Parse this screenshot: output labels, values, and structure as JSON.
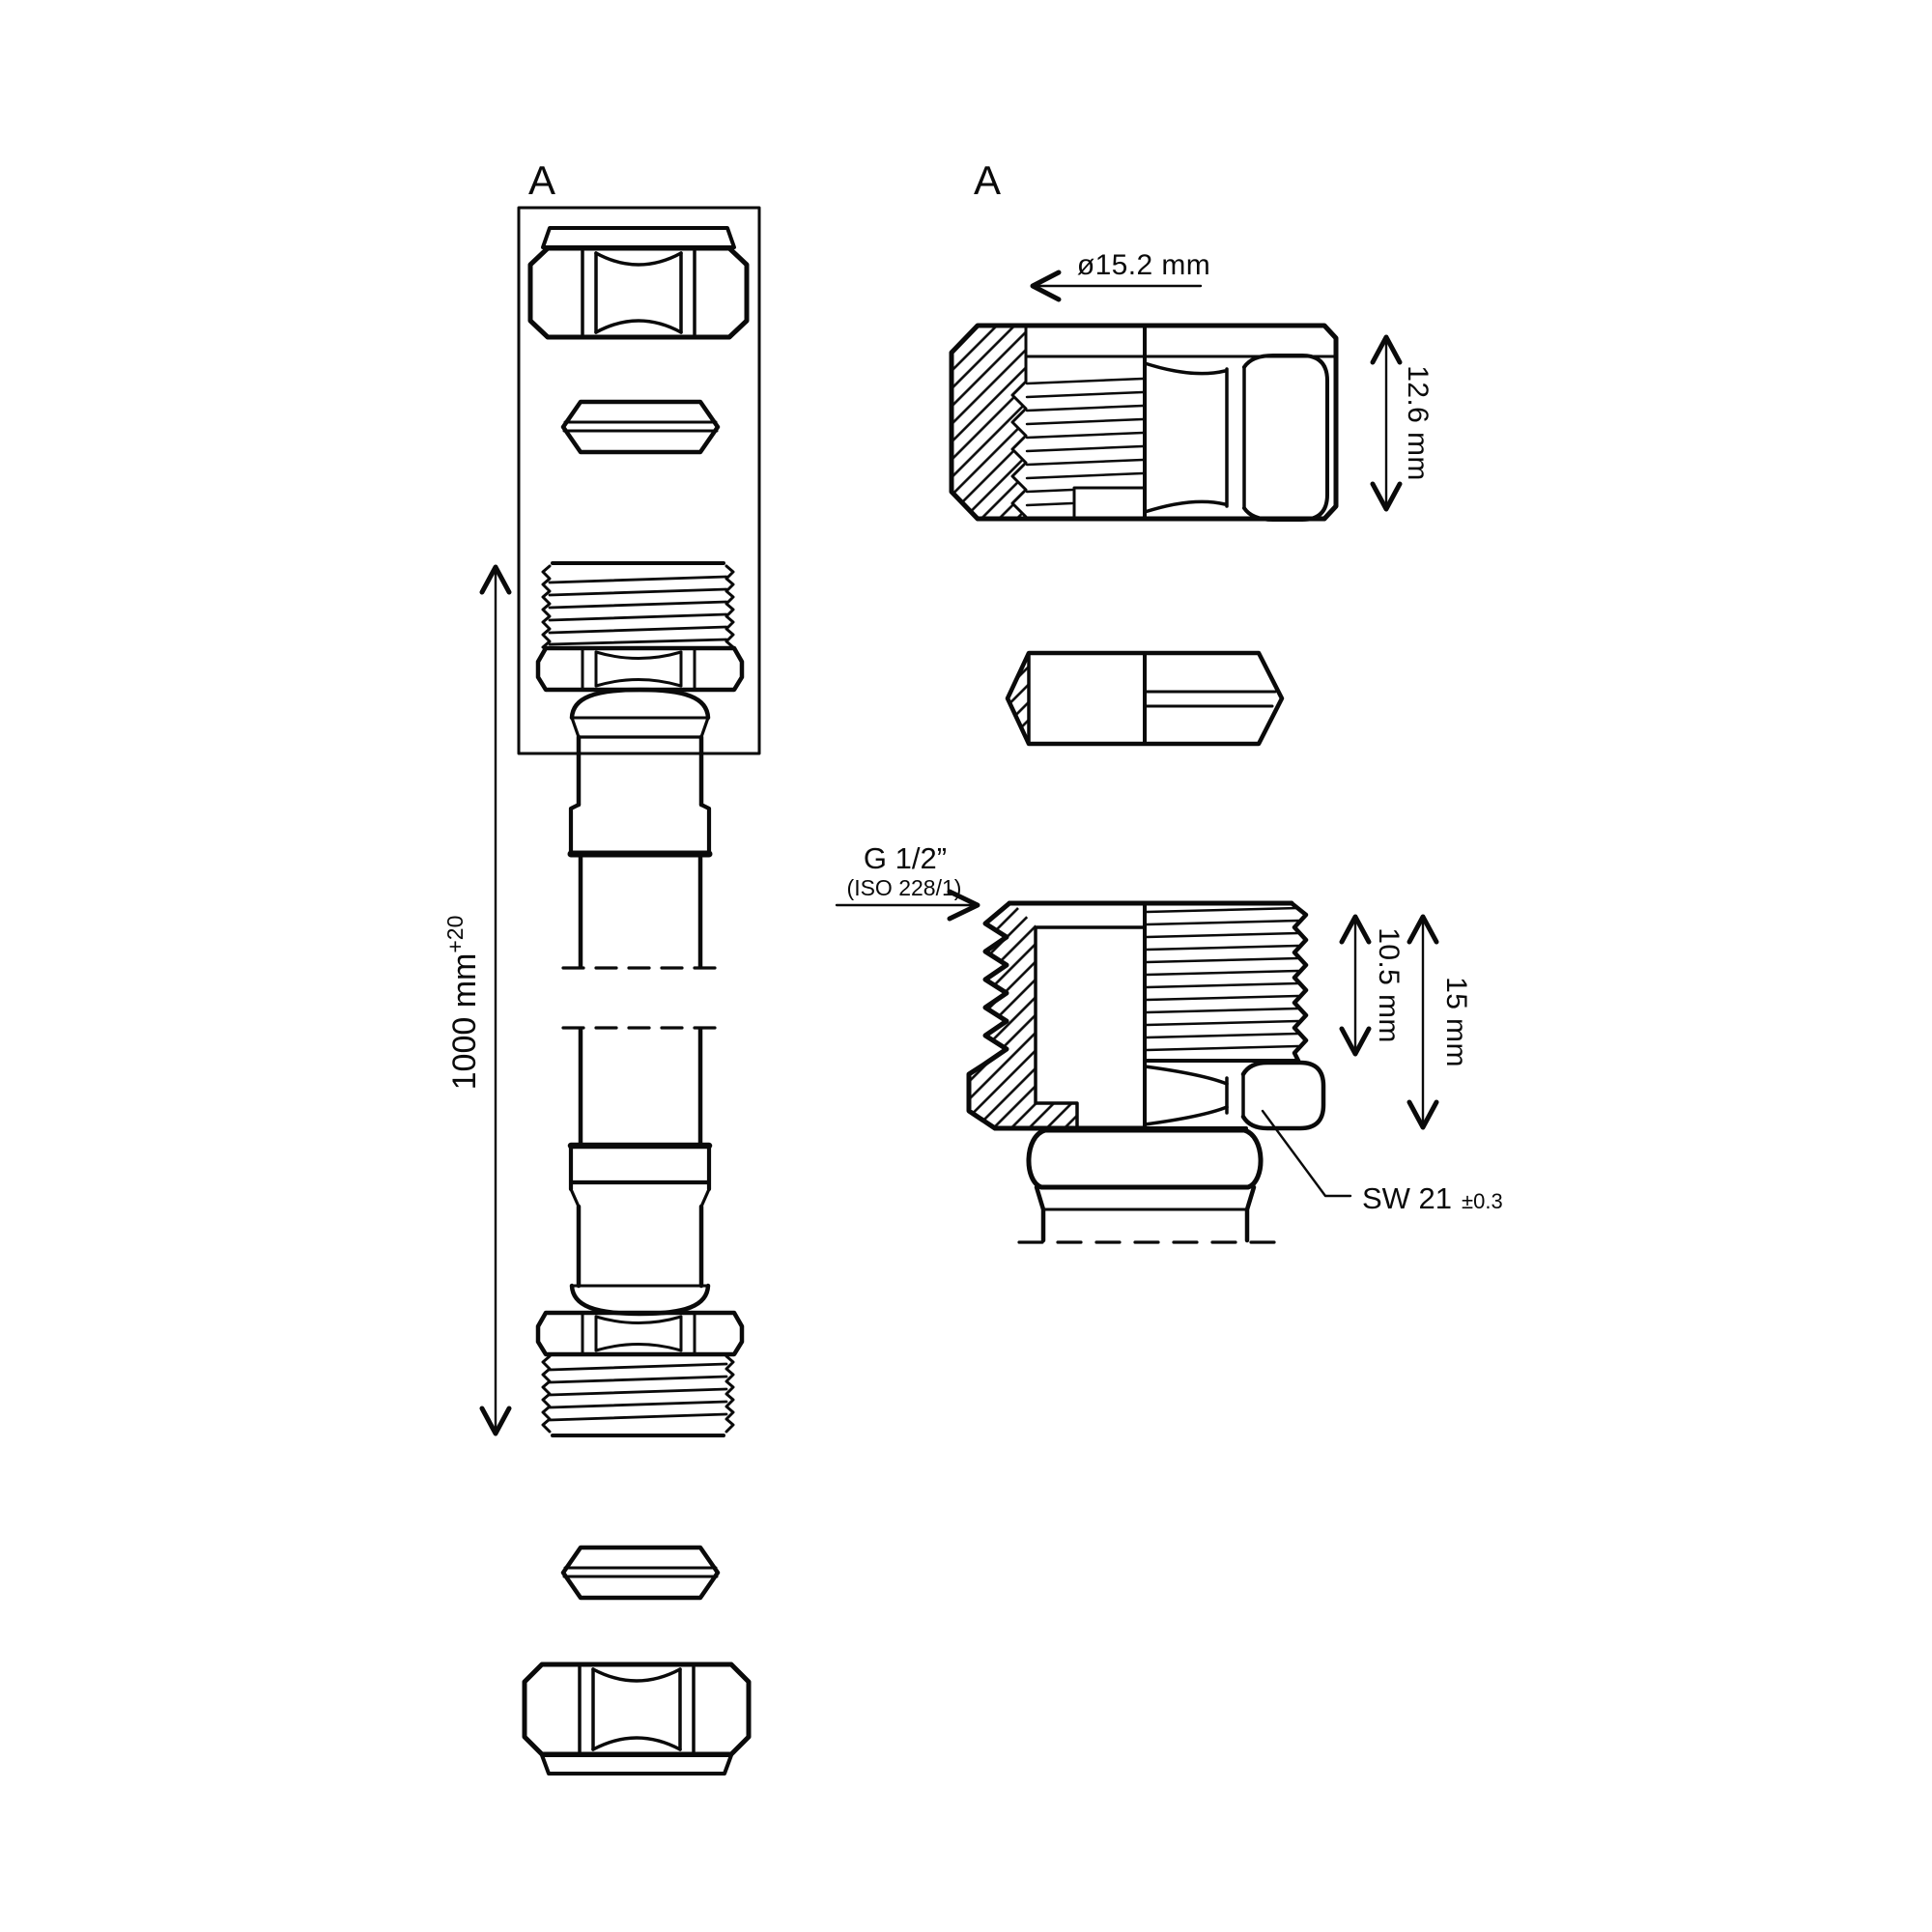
{
  "colors": {
    "ink": "#0a0a0a",
    "paper": "#ffffff"
  },
  "left_view": {
    "detail_label": "A",
    "length_dimension": {
      "value": "1000 mm",
      "tolerance": "+20"
    }
  },
  "detail_view": {
    "label": "A",
    "dimensions": {
      "outer_diameter": "ø15.2 mm",
      "nut_height": "12.6 mm",
      "thread_length": "10.5 mm",
      "insert_length": "15 mm"
    },
    "thread_callout": {
      "size": "G 1/2”",
      "standard": "(ISO 228/1)"
    },
    "wrench_callout": {
      "size": "SW 21",
      "tolerance": "±0.3"
    }
  }
}
